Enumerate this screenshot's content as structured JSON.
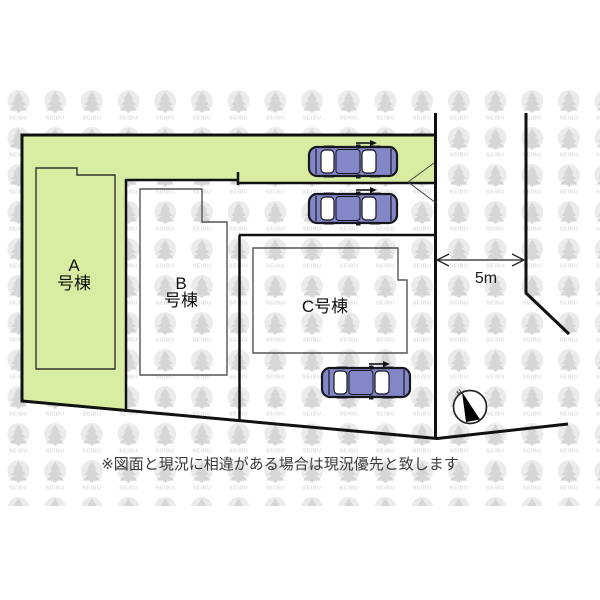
{
  "plan": {
    "buildings": {
      "a": {
        "label_line1": "A",
        "label_line2": "号棟"
      },
      "b": {
        "label_line1": "B",
        "label_line2": "号棟"
      },
      "c": {
        "label": "C号棟"
      }
    },
    "dimension": {
      "label": "5m"
    },
    "compass": {
      "label": "N"
    },
    "cars": {
      "count": 3
    }
  },
  "watermark": {
    "label": "SEIBU"
  },
  "disclaimer": "※図面と現況に相違がある場合は現況優先と致します",
  "colors": {
    "lot_green": "#d9eda2",
    "car_body": "#8487c7",
    "line": "#111111",
    "thin_outline": "#555555",
    "text_dark": "#1b1b1b"
  }
}
